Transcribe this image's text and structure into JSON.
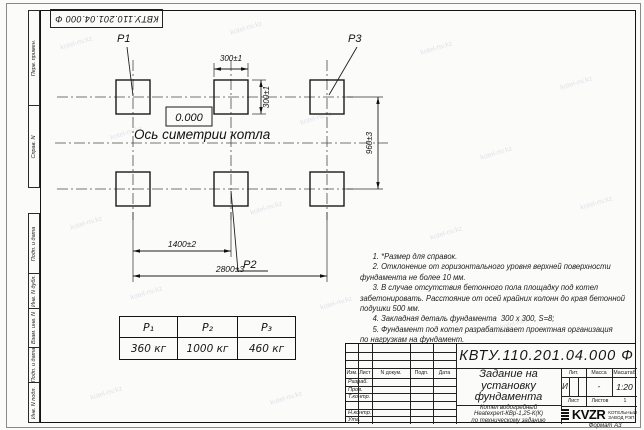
{
  "watermark": "kotel-nv.kz",
  "stamp": {
    "doc_number_inverted": "КВТУ.110.201.04.000  Ф"
  },
  "margin": {
    "top_cells": [
      "Перв. примен.",
      "Справ. N"
    ],
    "bottom_cells": [
      "Подп. и дата",
      "Инв. N дубл.",
      "Взам. инв. N",
      "Подп. и дата",
      "Инв. N подл."
    ]
  },
  "drawing": {
    "p1_label": "P1",
    "p2_label": "P2",
    "p3_label": "P3",
    "level_mark": "0.000",
    "axis_caption": "Ось симетрии котла",
    "dim_pad_width": "300±1",
    "dim_pad_height": "300±1",
    "dim_rows": "960±3",
    "dim_col1": "1400±2",
    "dim_total": "2800±3"
  },
  "load_table": {
    "headers": [
      "P₁",
      "P₂",
      "P₃"
    ],
    "values": [
      "360 кг",
      "1000 кг",
      "460 кг"
    ]
  },
  "notes": [
    "      1. *Размер для справок.",
    "      2. Отклонение от горизонтального уровня верхней поверхности",
    "фундамента не более 10 мм.",
    "      3. В случае отсутствия бетонного пола площадку под котел",
    "забетонировать. Расстояние от осей крайних колонн до края бетонной",
    "подушки 500 мм.",
    "      4. Закладная деталь фундамента  300 х 300, S=8;",
    "      5. Фундамент под котел разрабатывает проектная организация",
    "по нагрузкам на фундамент."
  ],
  "title_block": {
    "doc_number": "КВТУ.110.201.04.000  Ф",
    "title_line1": "Задание на",
    "title_line2": "установку",
    "title_line3": "фундамента",
    "object_line1": "Котел водогрейный",
    "object_line2": "Heatexpert-КВр-1,25-К(К)",
    "object_line3": "по техническому заданию",
    "rev_cols": [
      "Изм.",
      "Лист",
      "N докум.",
      "Подп.",
      "Дата"
    ],
    "roles": [
      "Разраб.",
      "Пров.",
      "Т.контр.",
      "",
      "Н.контр.",
      "Утв."
    ],
    "lit_label": "Лит.",
    "mass_label": "Масса",
    "scale_label": "Масштаб",
    "lit_value": "И",
    "mass_value": "-",
    "scale_value": "1:20",
    "sheet_label": "Лист",
    "sheets_label": "Листов",
    "sheets_value": "1",
    "brand": "KVZR",
    "brand_line1": "КОТЕЛЬНЫЙ",
    "brand_line2": "ЗАВОД РЭП",
    "format_label": "Формат А3"
  }
}
